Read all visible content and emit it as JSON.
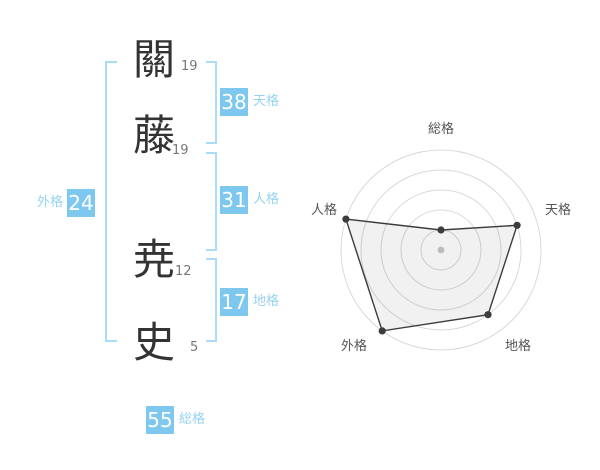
{
  "name_display": {
    "surname": [
      {
        "char": "關",
        "strokes": "19"
      },
      {
        "char": "藤",
        "strokes": "19"
      }
    ],
    "given": [
      {
        "char": "尭",
        "strokes": "12"
      },
      {
        "char": "史",
        "strokes": "5"
      }
    ],
    "kaku": {
      "tenkaku": {
        "value": "38",
        "label": "天格"
      },
      "jinkaku": {
        "value": "31",
        "label": "人格"
      },
      "chikaku": {
        "value": "17",
        "label": "地格"
      },
      "gaikaku": {
        "value": "24",
        "label": "外格"
      },
      "soukaku": {
        "value": "55",
        "label": "総格"
      }
    }
  },
  "colors": {
    "badge_blue": "#7ec8f0",
    "label_blue": "#96d2f3",
    "bracket_blue": "#aadcf7",
    "kanji_dark": "#333333",
    "stroke_number_gray": "#777777",
    "chart_line": "#3c3c3c",
    "chart_ring": "#d9d9d9",
    "chart_fill": "rgba(0,0,0,0.055)",
    "chart_label": "#555555",
    "chart_center_dot": "#bcbcbc"
  },
  "chart_data": {
    "type": "radar",
    "axes": [
      "総格",
      "天格",
      "地格",
      "外格",
      "人格"
    ],
    "axis_order": "clockwise-from-top",
    "ring_values": [
      1,
      4,
      4,
      5,
      5
    ],
    "max": 5,
    "rings": 5,
    "grid": "concentric-circles",
    "legend": "none",
    "kaku_numbers": {
      "総格": 55,
      "天格": 38,
      "地格": 17,
      "外格": 24,
      "人格": 31
    }
  }
}
